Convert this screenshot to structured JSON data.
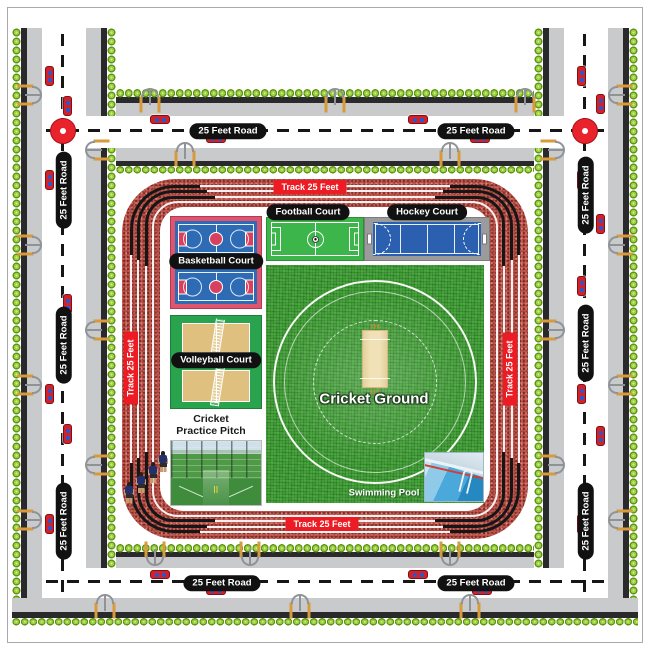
{
  "diagram": {
    "kind": "sports-complex-layout-plan"
  },
  "roads": {
    "label": "25 Feet Road"
  },
  "track": {
    "label": "Track 25 Feet"
  },
  "facilities": {
    "basketball": {
      "label": "Basketball Court"
    },
    "football": {
      "label": "Football Court"
    },
    "hockey": {
      "label": "Hockey Court"
    },
    "volleyball": {
      "label": "Volleyball Court"
    },
    "cricket_practice": {
      "label_line1": "Cricket",
      "label_line2": "Practice Pitch"
    },
    "cricket_ground": {
      "label": "Cricket Ground"
    },
    "swimming_pool": {
      "label": "Swimming Pool"
    }
  },
  "colors": {
    "road_surface": "#ffffff",
    "sidewalk": "#c9cacc",
    "curb": "#2a2a2c",
    "hedge_green": "#97ca3d",
    "roundabout_red": "#e8232b",
    "car_red": "#d42027",
    "car_window_blue": "#2b55c8",
    "track_red": "#c0574f",
    "track_label_red": "#ed1c24",
    "label_pill_black": "#111111",
    "basketball_blue": "#2e6bb5",
    "basketball_pink": "#e0556e",
    "football_green": "#3cb54a",
    "hockey_blue": "#2b5fb0",
    "hockey_gray": "#9b9b9b",
    "volleyball_tan": "#dfc07e",
    "volleyball_green": "#2aa34f",
    "grass_green": "#44a338",
    "pitch_tan": "#e9d9a8",
    "pool_blue": "#2e8fc6"
  }
}
